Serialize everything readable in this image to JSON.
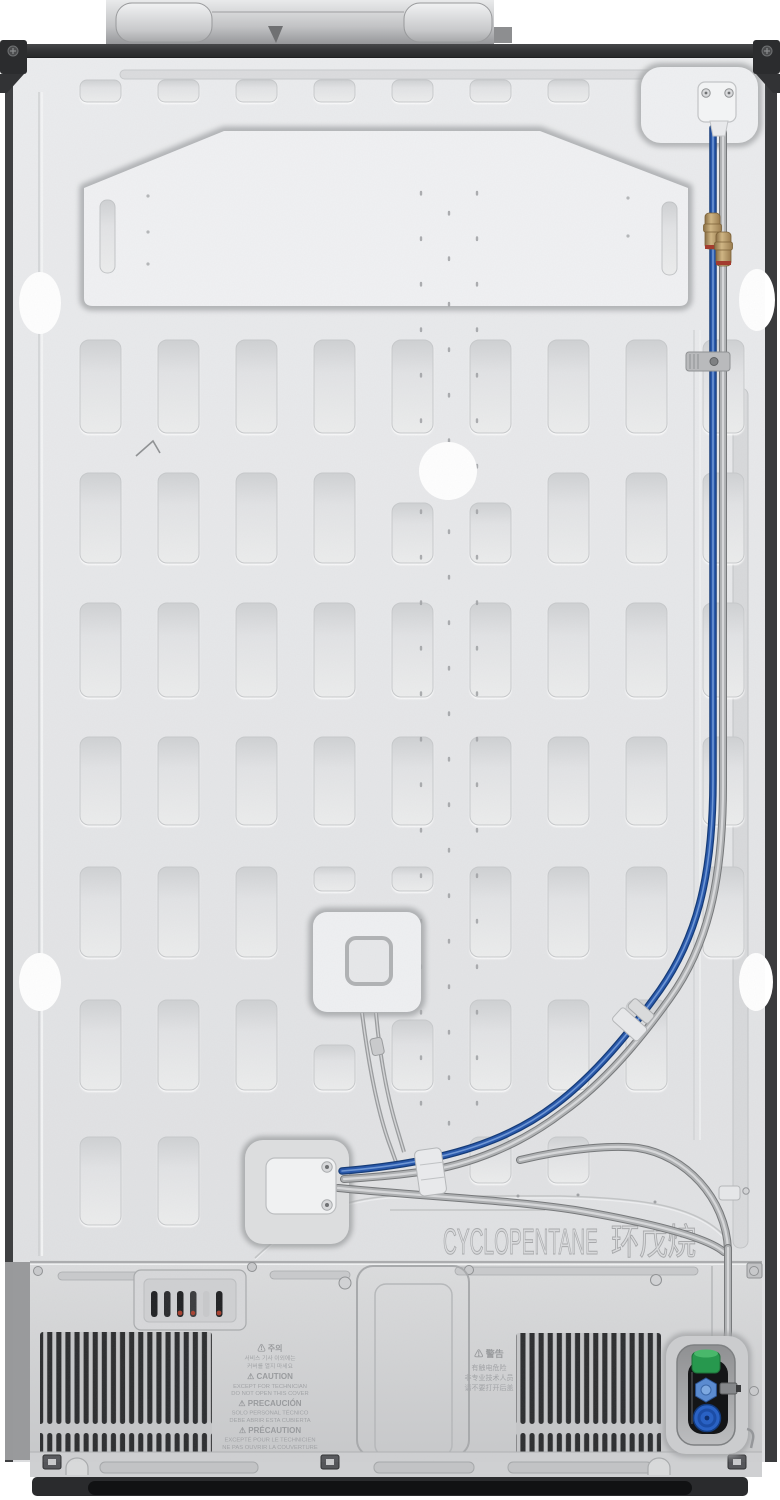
{
  "stamped_labels": {
    "blowing_agent": {
      "en": "CYCLOPENTANE",
      "zh": "环戊烷"
    },
    "caution": {
      "ko": {
        "title": "⚠ 주의",
        "lines": [
          "서비스 기사 이외에는",
          "커버를 열지 마세요"
        ]
      },
      "en": {
        "title": "⚠ CAUTION",
        "lines": [
          "EXCEPT FOR TECHNICIAN",
          "DO NOT OPEN THIS COVER"
        ]
      },
      "es": {
        "title": "⚠ PRECAUCIÓN",
        "lines": [
          "SOLO PERSONAL TÉCNICO",
          "DEBE ABRIR ESTA CUBIERTA"
        ]
      },
      "fr": {
        "title": "⚠ PRÉCAUTION",
        "lines": [
          "EXCEPTÉ POUR LE TECHNICIEN",
          "NE PAS OUVRIR LA COUVERTURE"
        ]
      }
    },
    "warning_zh": {
      "title": "⚠ 警告",
      "lines": [
        "有触电危险",
        "非专业技术人员",
        "请不要打开后盖"
      ]
    }
  },
  "colors": {
    "panel_silver": "#e6e7e9",
    "frame_dark": "#2f3032",
    "water_tube_blue": "#2456a8",
    "tube_gray": "#a9abad",
    "brass_fitting": "#b5925c",
    "valve_cap_green": "#27984e",
    "valve_cap_blue": "#2a62c4",
    "sticker_white": "#ffffff"
  }
}
